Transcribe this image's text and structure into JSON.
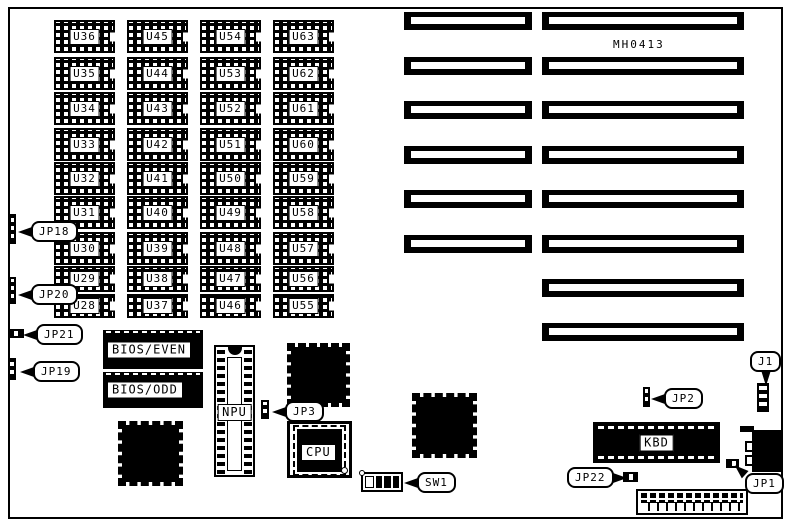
{
  "board": {
    "part_number": "MH0413",
    "ink_color": "#000000",
    "background_color": "#ffffff"
  },
  "dram_grid": {
    "columns": [
      {
        "labels": [
          "U36",
          "U35",
          "U34",
          "U33",
          "U32",
          "U31",
          "U30",
          "U29",
          "U28"
        ]
      },
      {
        "labels": [
          "U45",
          "U44",
          "U43",
          "U42",
          "U41",
          "U40",
          "U39",
          "U38",
          "U37"
        ]
      },
      {
        "labels": [
          "U54",
          "U53",
          "U52",
          "U51",
          "U50",
          "U49",
          "U48",
          "U47",
          "U46"
        ]
      },
      {
        "labels": [
          "U63",
          "U62",
          "U61",
          "U60",
          "U59",
          "U58",
          "U57",
          "U56",
          "U55"
        ]
      }
    ]
  },
  "expansion_slots": {
    "rows": [
      {
        "segments": [
          "short",
          "long"
        ]
      },
      {
        "segments": [
          "short",
          "long"
        ]
      },
      {
        "segments": [
          "short",
          "long"
        ]
      },
      {
        "segments": [
          "short",
          "long"
        ]
      },
      {
        "segments": [
          "short",
          "long"
        ]
      },
      {
        "segments": [
          "short",
          "long"
        ]
      },
      {
        "segments": [
          "long"
        ]
      },
      {
        "segments": [
          "long"
        ]
      }
    ]
  },
  "ics": {
    "bios_even": "BIOS/EVEN",
    "bios_odd": "BIOS/ODD",
    "npu": "NPU",
    "cpu": "CPU",
    "kbd": "KBD"
  },
  "callouts": [
    {
      "id": "jp18",
      "label": "JP18"
    },
    {
      "id": "jp20",
      "label": "JP20"
    },
    {
      "id": "jp21",
      "label": "JP21"
    },
    {
      "id": "jp19",
      "label": "JP19"
    },
    {
      "id": "jp3",
      "label": "JP3"
    },
    {
      "id": "sw1",
      "label": "SW1"
    },
    {
      "id": "jp2",
      "label": "JP2"
    },
    {
      "id": "j1",
      "label": "J1"
    },
    {
      "id": "jp22",
      "label": "JP22"
    },
    {
      "id": "jp1",
      "label": "JP1"
    }
  ],
  "sw1": {
    "positions": [
      "off",
      "on",
      "on",
      "on"
    ]
  }
}
